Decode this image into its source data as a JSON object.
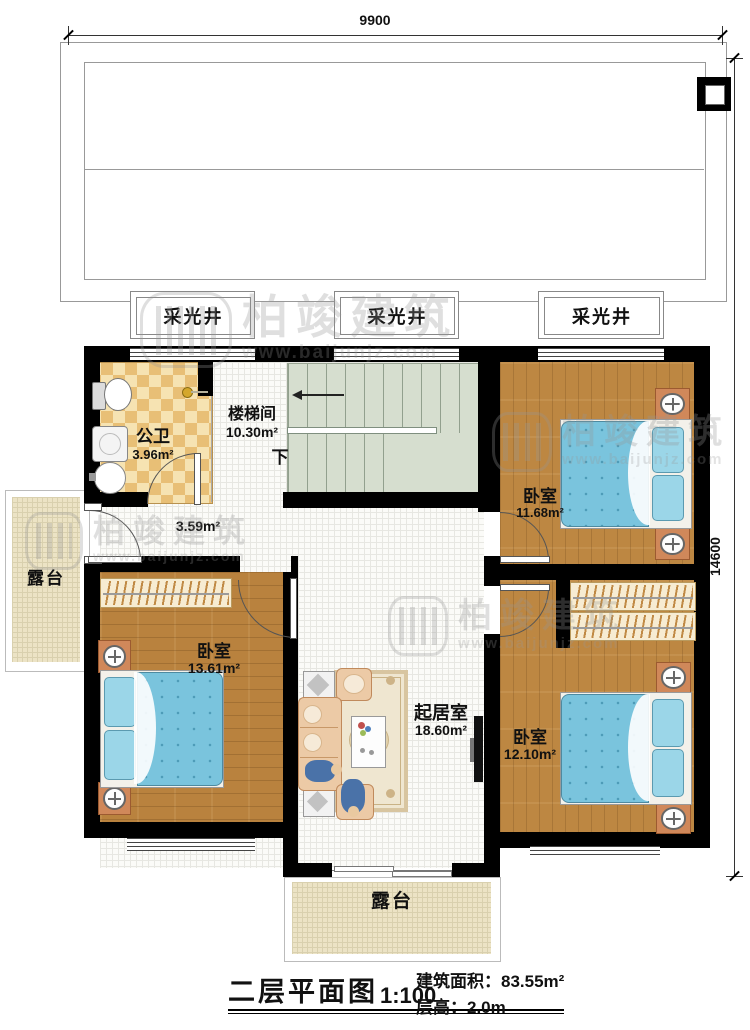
{
  "dimensions": {
    "width_label": "9900",
    "height_label": "14600"
  },
  "skylights": {
    "s1": "采光井",
    "s2": "采光井",
    "s3": "采光井"
  },
  "rooms": {
    "bathroom": {
      "name": "公卫",
      "area": "3.96m²"
    },
    "stairwell": {
      "name": "楼梯间",
      "area": "10.30m²",
      "down": "下"
    },
    "hall": {
      "area": "3.59m²"
    },
    "bedroom_ne": {
      "name": "卧室",
      "area": "11.68m²"
    },
    "bedroom_w": {
      "name": "卧室",
      "area": "13.61m²"
    },
    "bedroom_se": {
      "name": "卧室",
      "area": "12.10m²"
    },
    "living": {
      "name": "起居室",
      "area": "18.60m²"
    },
    "terrace_left": {
      "name": "露台"
    },
    "terrace_bottom": {
      "name": "露台"
    }
  },
  "titleblock": {
    "title": "二层平面图",
    "scale": "1:100",
    "area_label": "建筑面积：",
    "area_value": "83.55m²",
    "height_label": "层高：",
    "height_value": "2.0m"
  },
  "watermark": {
    "brand": "柏竣建筑",
    "url": "www.baijunjz.com"
  },
  "colors": {
    "wall": "#000000",
    "wood_floor": "#b9823e",
    "bed_blue": "#7ac4dd",
    "tile_gold": "#e8bf76",
    "stair_green": "#d6decf",
    "terrace_beige": "#ece3c5",
    "lamp_copper": "#d0885a"
  }
}
